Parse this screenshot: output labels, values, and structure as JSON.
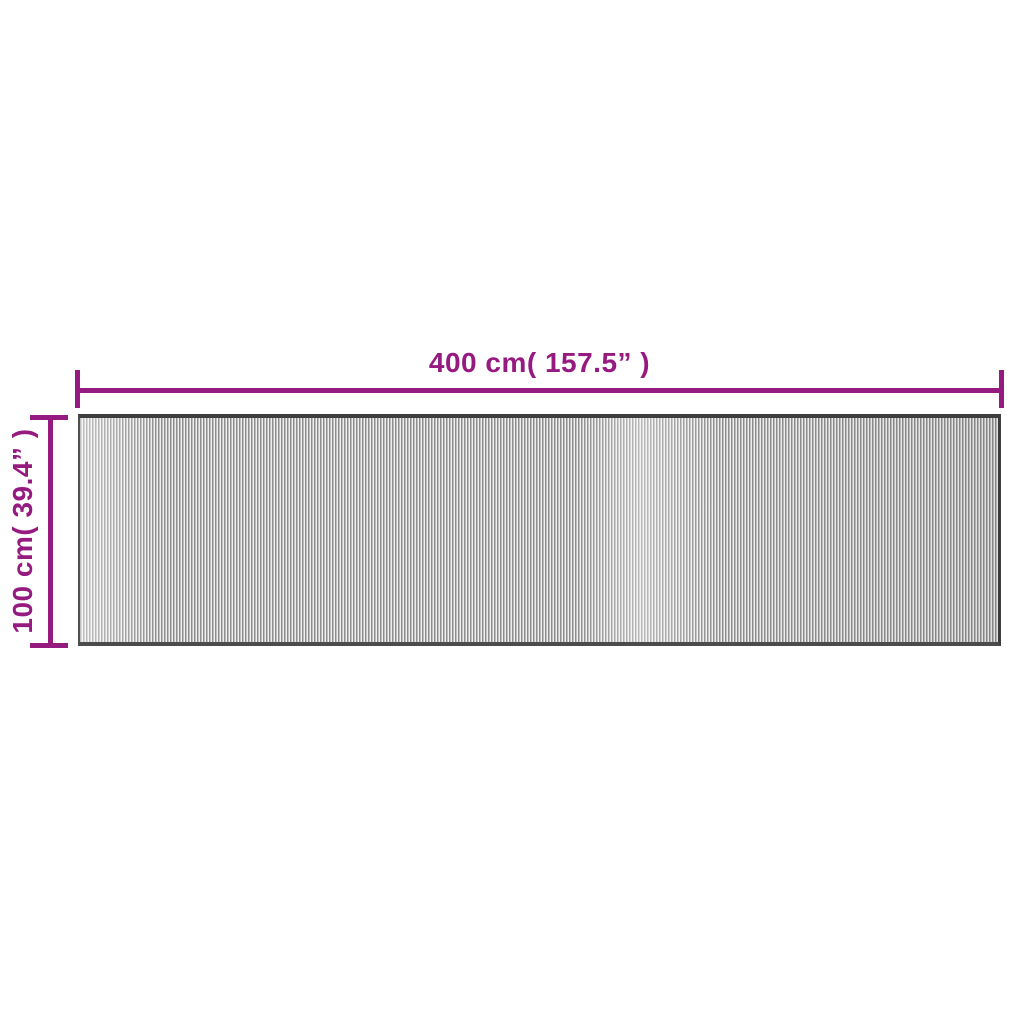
{
  "diagram": {
    "width_label": "400 cm( 157.5” )",
    "height_label": "100 cm( 39.4” )",
    "accent_color": "#951b81",
    "rug": {
      "texture": "vertical-stripes",
      "stripe_dark_color": "#8d8d8d",
      "stripe_light_color": "#efefef",
      "edge_color": "#3d3d3d"
    }
  }
}
